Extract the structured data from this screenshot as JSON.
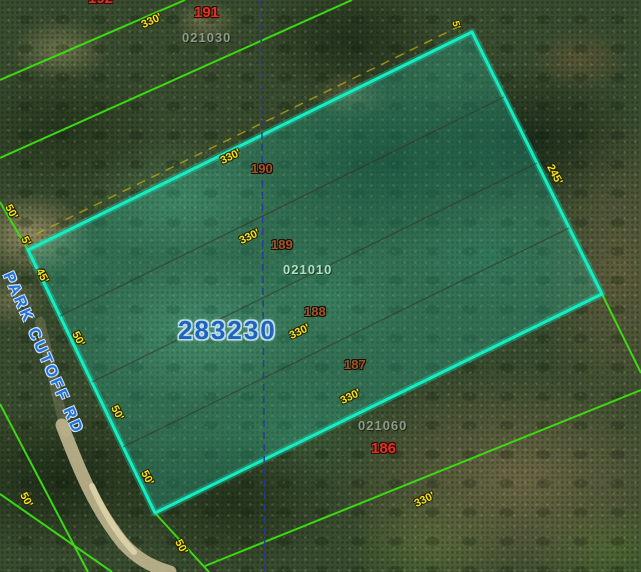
{
  "map": {
    "selected_parcel": {
      "number": "283230",
      "alt_key": "021010",
      "lots": [
        {
          "n": "190"
        },
        {
          "n": "189"
        },
        {
          "n": "188"
        },
        {
          "n": "187"
        }
      ]
    },
    "adjacent": {
      "north": {
        "partial_lot": "192",
        "lot": "191",
        "alt_key": "021030"
      },
      "southeast": {
        "lot": "186",
        "alt_key": "021060"
      }
    },
    "road": {
      "name": "PARK CUTOFF RD"
    },
    "dims": {
      "d330": "330'",
      "d245": "245'",
      "d50": "50'",
      "d45": "45'",
      "d5": "5'"
    },
    "colors": {
      "selected_boundary": "#14eec2",
      "parcel_line_green": "#3ce012",
      "dimension_yellow": "#efe51a",
      "dimension_dash_yellow": "#c3b20c",
      "lot_number_brown": "#9d5629",
      "parcel_number_red": "#e23222",
      "alt_key_gray_green": "#8e9a88",
      "alt_key_mint": "#b2dfbd",
      "selected_number_blue": "#2062bc",
      "road_blue": "#2071de",
      "survey_dash_navy": "#27399b"
    }
  }
}
